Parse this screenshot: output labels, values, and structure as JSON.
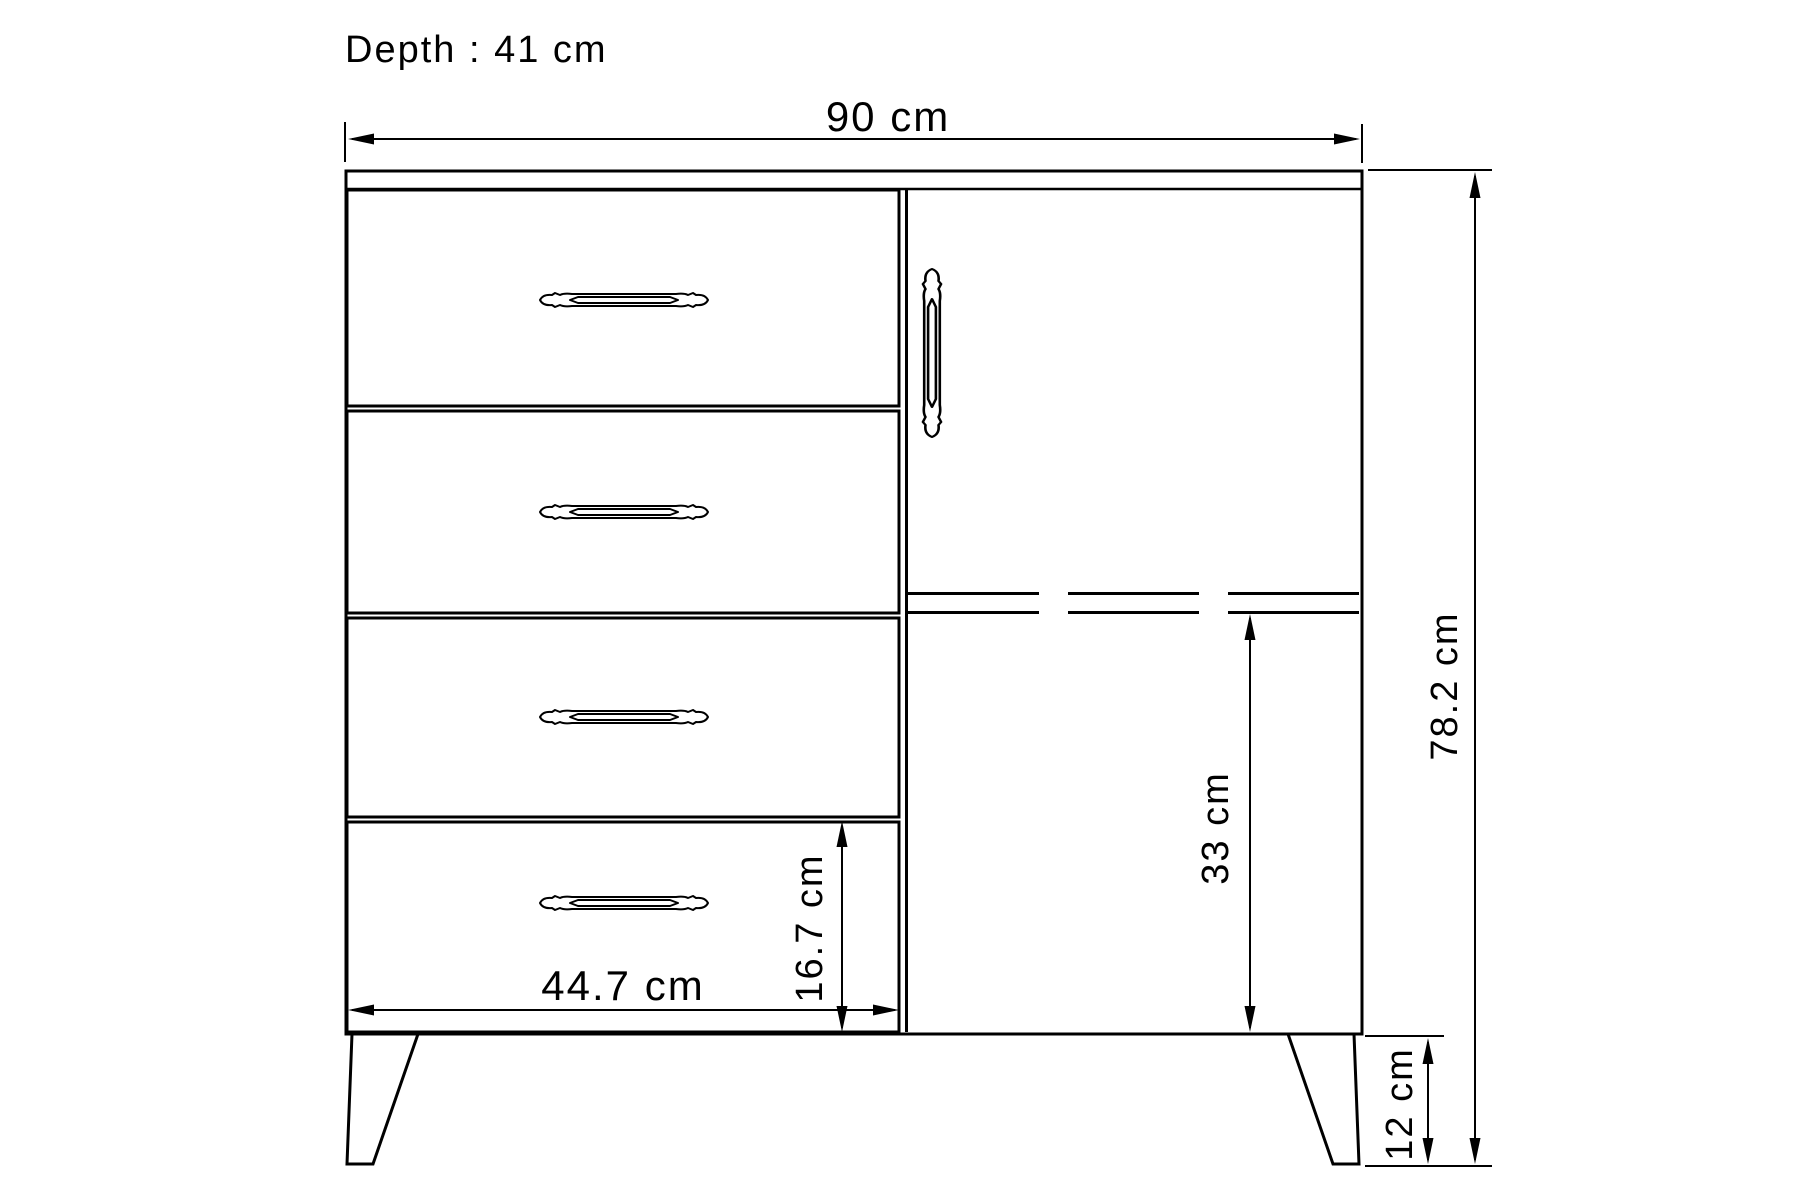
{
  "drawing": {
    "background_color": "#ffffff",
    "line_color": "#000000",
    "depth_label": "Depth : 41 cm",
    "width_label": "90 cm",
    "height_label": "78.2 cm",
    "compartment_height_label": "33 cm",
    "bottom_drawer_height_label": "16.7 cm",
    "drawer_width_label": "44.7 cm",
    "leg_height_label": "12 cm"
  }
}
